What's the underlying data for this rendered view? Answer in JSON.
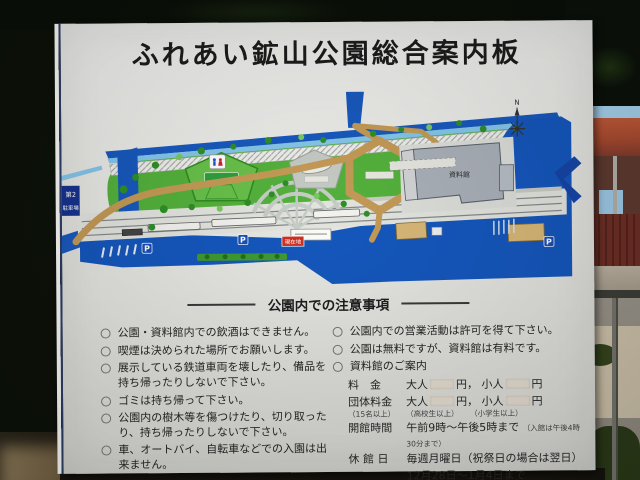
{
  "sign": {
    "title": "ふれあい鉱山公園総合案内板",
    "map": {
      "parking_area_label": [
        "第2",
        "駐車場"
      ],
      "compass_north": "N",
      "parking_icon": "P",
      "you_are_here_label": "現在地",
      "museum_label": "資料館"
    },
    "notice": {
      "header": "公園内での注意事項",
      "left_items": [
        "公園・資料館内での飲酒はできません。",
        "喫煙は決められた場所でお願いします。",
        "展示している鉄道車両を壊したり、備品を持ち帰ったりしないで下さい。",
        "ゴミは持ち帰って下さい。",
        "公園内の樹木等を傷つけたり、切り取ったり、持ち帰ったりしないで下さい。",
        "車、オートバイ、自転車などでの入園は出来ません。"
      ],
      "right_items": [
        "公園内での営業活動は許可を得て下さい。",
        "公園は無料ですが、資料館は有料です。",
        "資料館のご案内"
      ],
      "museum_guide": {
        "fee_label": "料　金",
        "group_label": "団体料金",
        "group_note": "（15名以上）",
        "adult": "大人",
        "child": "小人",
        "yen_after_adult": "円，",
        "yen_after_child": "円",
        "adult_qualifier": "（高校生以上）",
        "child_qualifier": "（小学生以上）",
        "hours_label": "開館時間",
        "hours_value": "午前9時～午後5時まで",
        "hours_note": "（入館は午後4時30分まで）",
        "closed_label": "休 館 日",
        "closed_line1": "毎週月曜日（祝祭日の場合は翌日）",
        "closed_line2": "12月28日～1月4日まで"
      }
    },
    "colors": {
      "road_blue": "#1557bd",
      "stream_blue": "#85c6ea",
      "park_green": "#54b13c",
      "path_tan": "#c49a56",
      "marker_red": "#d03020"
    }
  }
}
